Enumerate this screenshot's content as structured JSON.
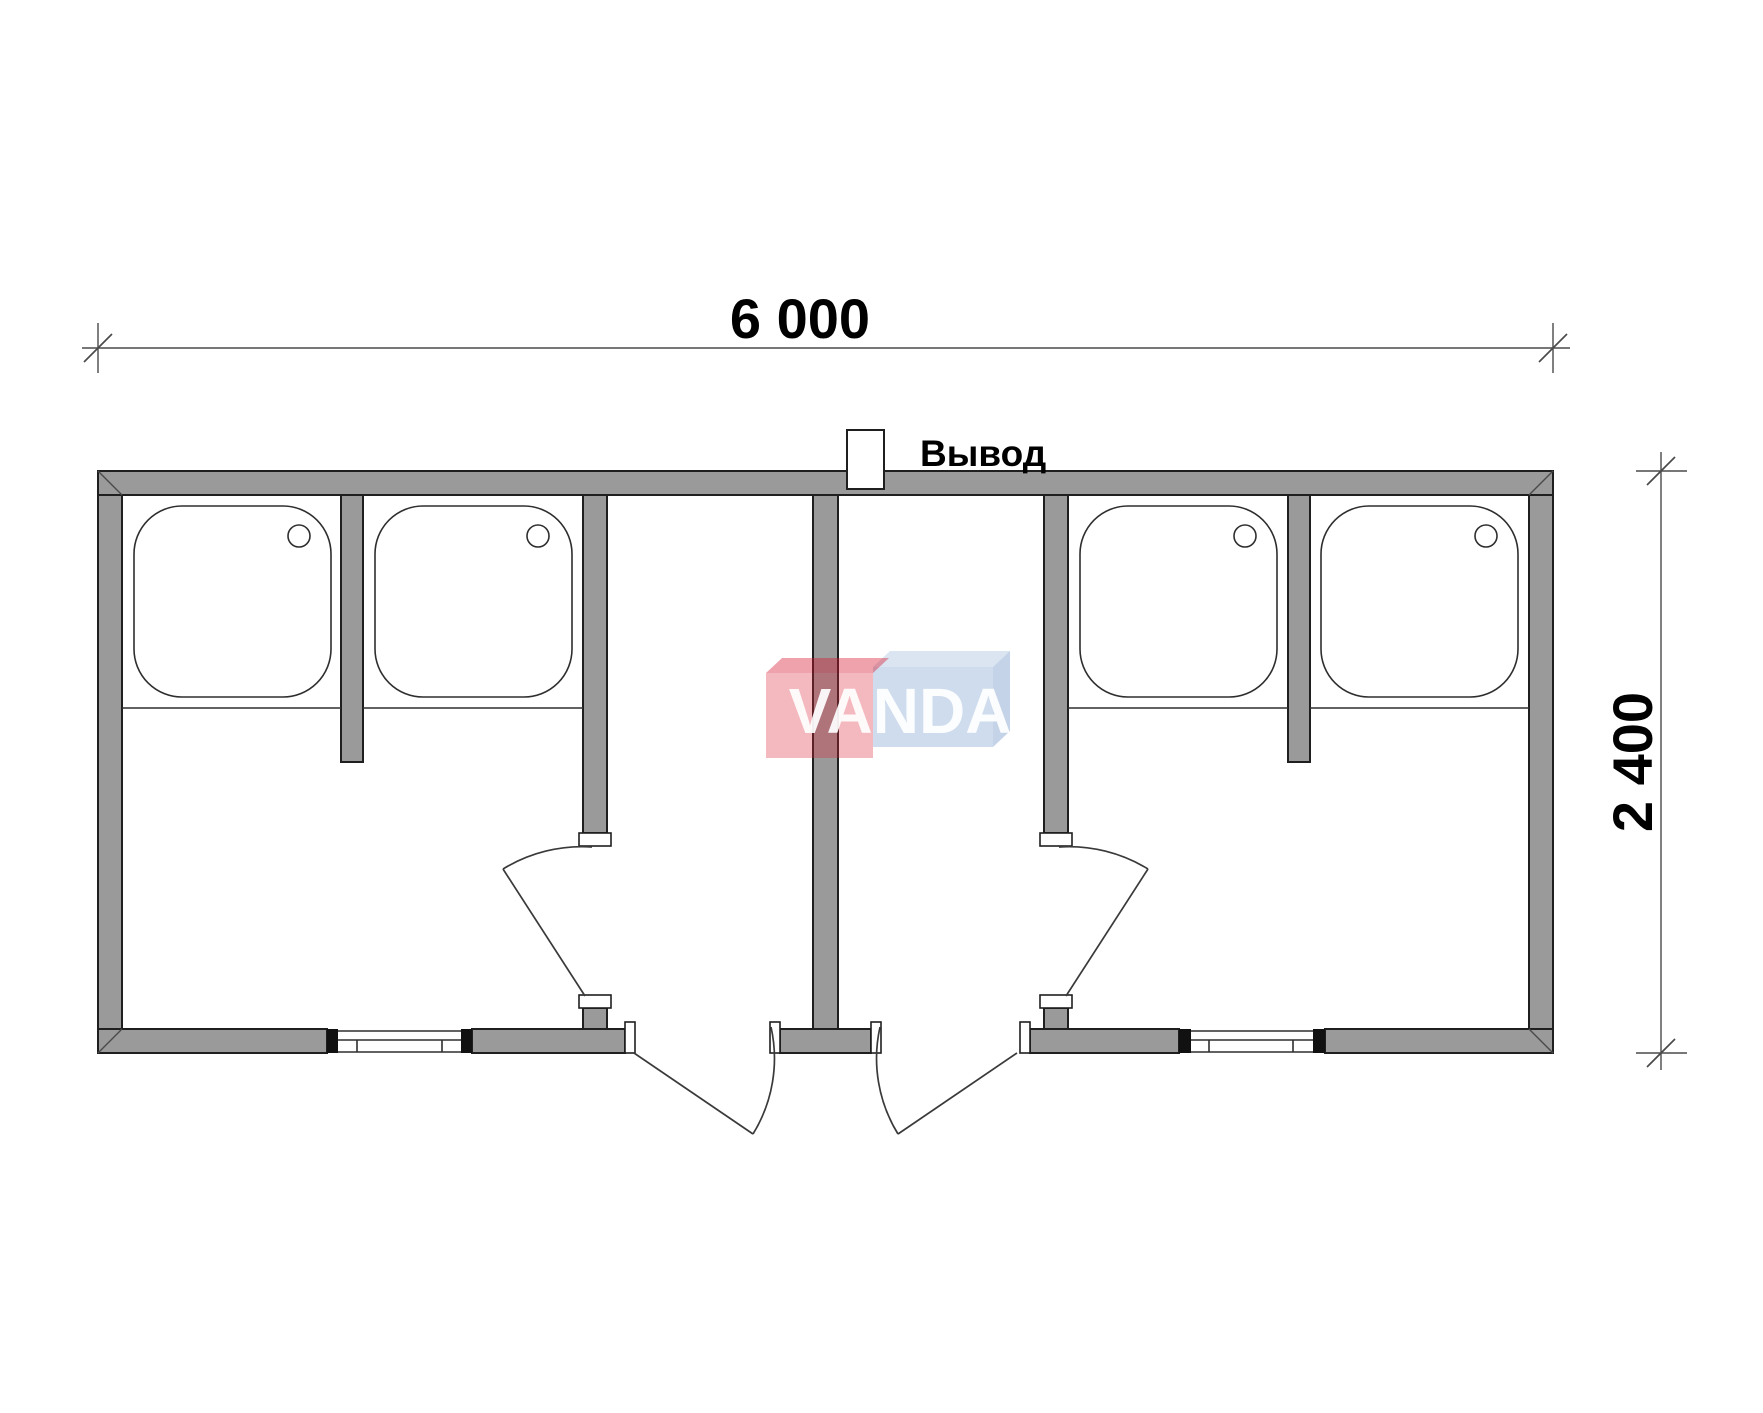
{
  "drawing": {
    "type": "floor-plan",
    "dimensions": {
      "width_label": "6 000",
      "height_label": "2 400"
    },
    "outlet": {
      "label": "Вывод"
    },
    "logo": {
      "text": "VANDA",
      "red_front": "rgba(220,35,55,0.32)",
      "red_top": "rgba(214,22,44,0.40)",
      "blue_front": "rgba(105,148,200,0.33)",
      "blue_top": "rgba(109,150,200,0.25)",
      "blue_side": "rgba(100,140,195,0.38)",
      "letters": "rgba(255,255,255,0.92)"
    },
    "colors": {
      "wall_fill": "#9a9a9a",
      "wall_outline": "#1f1f1f",
      "line": "#2e2e2e",
      "dimension_line": "#4a4a4a",
      "text": "#000000"
    },
    "fixtures": {
      "shower_tray_count": 4,
      "window_count": 2,
      "door_count": 4
    }
  }
}
